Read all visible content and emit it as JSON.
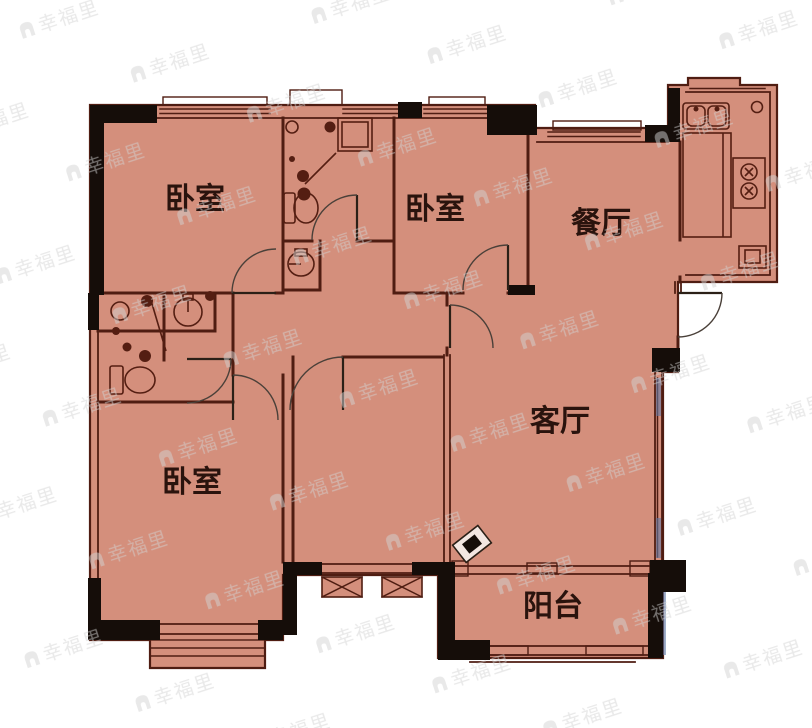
{
  "plan": {
    "watermark_text": "幸福里",
    "colors": {
      "background": "#ffffff",
      "floor": "#d48f7c",
      "wall_thin": "#4f1d12",
      "wall_thick": "#150d09",
      "label": "#2a130d",
      "door": "#4a4039",
      "window_accent": "#6079a6",
      "fixture": "#541e12",
      "watermark": "#d2d2d2"
    },
    "rooms": [
      {
        "id": "bedroom-1",
        "label": "卧室"
      },
      {
        "id": "bedroom-2",
        "label": "卧室"
      },
      {
        "id": "dining-room",
        "label": "餐厅"
      },
      {
        "id": "living-room",
        "label": "客厅"
      },
      {
        "id": "bedroom-3",
        "label": "卧室"
      },
      {
        "id": "balcony",
        "label": "阳台"
      }
    ],
    "fixtures": {
      "kitchen": [
        "double-sink",
        "counter",
        "gas-stove",
        "appliance"
      ],
      "bath_top": [
        "shower",
        "toilet",
        "washbasin"
      ],
      "bath_left": [
        "shower",
        "toilet",
        "washbasin"
      ]
    }
  }
}
